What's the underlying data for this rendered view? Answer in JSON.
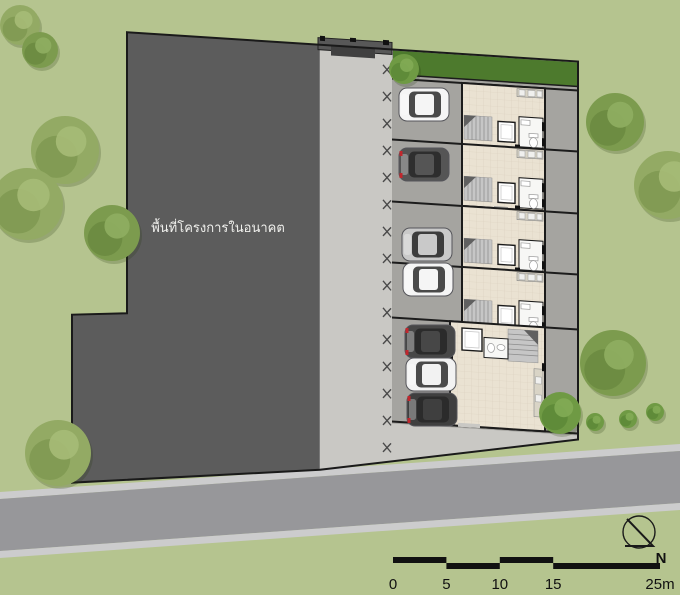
{
  "site": {
    "future_area_label": "พื้นที่โครงการในอนาคต",
    "units": {
      "standard_townhouse_count": 4,
      "corner_unit_count": 1
    },
    "parked_car_count": 7
  },
  "compass": {
    "label": "N"
  },
  "scale_bar": {
    "tick_labels": [
      "0",
      "5",
      "10",
      "15",
      "25m"
    ],
    "tick_values_m": [
      0,
      5,
      10,
      15,
      25
    ],
    "segments_m": [
      [
        0,
        5
      ],
      [
        5,
        10
      ],
      [
        10,
        15
      ],
      [
        15,
        25
      ]
    ],
    "total_m": 25
  },
  "colors": {
    "grass": "#b5c48f",
    "road": "#97979a",
    "curb": "#cccccd",
    "future_area": "#5c5c5c",
    "driveway": "#c9c8c4",
    "parking": "#a5a4a0",
    "floor": "#eae2d2",
    "tile_line": "#d9cfbe",
    "lawn": "#4d7a2d",
    "wall": "#1b1b1b",
    "label_text": "#efefec",
    "stairs": "#c6c6c6",
    "counter": "#d9d4c6",
    "bath_floor": "#f7f7f5"
  },
  "tree_palettes": {
    "a": [
      "#93aa64",
      "#7f9951",
      "#a6bb77"
    ],
    "b": [
      "#7c9b4e",
      "#6b8a41",
      "#8fae62"
    ],
    "c": [
      "#6f9a44",
      "#5d8837",
      "#82ab55"
    ]
  },
  "trees": [
    {
      "x": 20,
      "y": 25,
      "r": 20,
      "type": "a"
    },
    {
      "x": 40,
      "y": 50,
      "r": 18,
      "type": "b"
    },
    {
      "x": 65,
      "y": 150,
      "r": 34,
      "type": "a"
    },
    {
      "x": 27,
      "y": 204,
      "r": 36,
      "type": "a"
    },
    {
      "x": 112,
      "y": 233,
      "r": 28,
      "type": "b"
    },
    {
      "x": 58,
      "y": 453,
      "r": 33,
      "type": "a"
    },
    {
      "x": 615,
      "y": 122,
      "r": 29,
      "type": "b"
    },
    {
      "x": 668,
      "y": 185,
      "r": 34,
      "type": "a"
    },
    {
      "x": 613,
      "y": 363,
      "r": 33,
      "type": "b"
    },
    {
      "x": 560,
      "y": 413,
      "r": 21,
      "type": "c"
    },
    {
      "x": 404,
      "y": 69,
      "r": 15,
      "type": "c"
    },
    {
      "x": 595,
      "y": 422,
      "r": 9,
      "type": "c"
    },
    {
      "x": 628,
      "y": 419,
      "r": 9,
      "type": "c"
    },
    {
      "x": 655,
      "y": 412,
      "r": 9,
      "type": "c"
    }
  ],
  "cars": [
    {
      "x": 399,
      "y": 88,
      "body": "#f5f5f5",
      "glass": "#4a4a4a",
      "tail": false
    },
    {
      "x": 399,
      "y": 148,
      "body": "#555555",
      "glass": "#2e2e2e",
      "tail": true
    },
    {
      "x": 402,
      "y": 228,
      "body": "#c9c9c9",
      "glass": "#3c3c3c",
      "tail": false
    },
    {
      "x": 403,
      "y": 263,
      "body": "#f5f5f5",
      "glass": "#4a4a4a",
      "tail": false
    },
    {
      "x": 405,
      "y": 325,
      "body": "#474747",
      "glass": "#2b2b2b",
      "tail": true
    },
    {
      "x": 406,
      "y": 358,
      "body": "#f2f2f2",
      "glass": "#4a4a4a",
      "tail": false
    },
    {
      "x": 407,
      "y": 393,
      "body": "#3f3f3f",
      "glass": "#2b2b2b",
      "tail": true
    }
  ]
}
